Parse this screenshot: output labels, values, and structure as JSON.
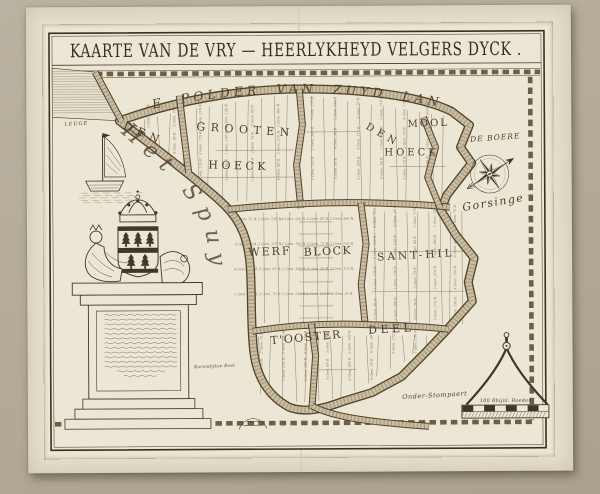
{
  "artwork": {
    "title": "KAARTE VAN DE VRY — HEERLYKHEYD VELGERS DYCK .",
    "inventory_mark": "RP-P-AO-14-60"
  },
  "map": {
    "border_label_top": "DE POLDER VAN ZUYD LAND",
    "water_name": "Het Spuy",
    "labels": [
      {
        "id": "den-grooten-1",
        "text": "DEN",
        "x": 143,
        "y": 136,
        "r": 24,
        "size": 11,
        "ls": 5.5
      },
      {
        "id": "den-grooten-2",
        "text": "GROOTEN",
        "x": 246,
        "y": 133,
        "r": 4,
        "size": 11,
        "ls": 5.5
      },
      {
        "id": "den-grooten-3",
        "text": "HOECK",
        "x": 239,
        "y": 169,
        "r": 2,
        "size": 11,
        "ls": 3.5
      },
      {
        "id": "den-mool-1",
        "text": "DEN",
        "x": 382,
        "y": 138,
        "r": 30,
        "size": 10,
        "ls": 4.5
      },
      {
        "id": "den-mool-2",
        "text": "MOOL",
        "x": 429,
        "y": 127,
        "r": -2,
        "size": 10,
        "ls": 2
      },
      {
        "id": "den-mool-3",
        "text": "HOECK",
        "x": 412,
        "y": 156,
        "r": 0,
        "size": 10,
        "ls": 3
      },
      {
        "id": "de-boere",
        "text": "DE BOERE",
        "x": 496,
        "y": 141,
        "r": -4,
        "size": 7.5,
        "ls": 1,
        "italic": true
      },
      {
        "id": "gorsinge",
        "text": "Gorsinge",
        "x": 494,
        "y": 207,
        "r": -9,
        "size": 11,
        "ls": 1.5,
        "italic": true
      },
      {
        "id": "werf",
        "text": "WERF",
        "x": 270,
        "y": 255,
        "r": -2,
        "size": 11,
        "ls": 2
      },
      {
        "id": "block",
        "text": "BLOCK",
        "x": 328,
        "y": 255,
        "r": -2,
        "size": 11,
        "ls": 1.5
      },
      {
        "id": "sant-hil",
        "text": "SANT-HIL",
        "x": 416,
        "y": 259,
        "r": -3,
        "size": 10.5,
        "ls": 3
      },
      {
        "id": "ooster-1",
        "text": "T'OOSTER",
        "x": 306,
        "y": 341,
        "r": -5,
        "size": 11,
        "ls": 1.5
      },
      {
        "id": "ooster-2",
        "text": "DEEL",
        "x": 391,
        "y": 333,
        "r": -3,
        "size": 11,
        "ls": 3.5
      },
      {
        "id": "leuge",
        "text": "LEUGE",
        "x": 77,
        "y": 124,
        "r": -2,
        "size": 5,
        "ls": 1,
        "italic": true
      },
      {
        "id": "boet",
        "text": "Korendijkse Boet",
        "x": 214,
        "y": 367,
        "r": -2,
        "size": 4.2,
        "ls": 0.3,
        "italic": true
      },
      {
        "id": "onder-stompaert",
        "text": "Onder-Stompaert",
        "x": 434,
        "y": 398,
        "r": -3,
        "size": 6.5,
        "ls": 0.5,
        "italic": true
      },
      {
        "id": "scale-label",
        "text": "100 Rhijnl. Roeden",
        "x": 505,
        "y": 403,
        "r": 0,
        "size": 4.8,
        "ls": 0.3,
        "italic": true
      }
    ],
    "parcel_note_samples": [
      "1 Gem. 150 R.",
      "2 Gem. 75 R.",
      "3 Gem. 210 R.",
      "4 Gem. 120 R.",
      "5 Gem. 95 R.",
      "2 Gem. 300 R.",
      "6 Gem. 50 R.",
      "3 Gem. 175 R."
    ],
    "colors": {
      "backdrop": "#b2aa96",
      "paper": "#e5e0cc",
      "plate": "#ece7d5",
      "ink": "#41352b",
      "dyke_fill": "#cbbfa1"
    }
  }
}
